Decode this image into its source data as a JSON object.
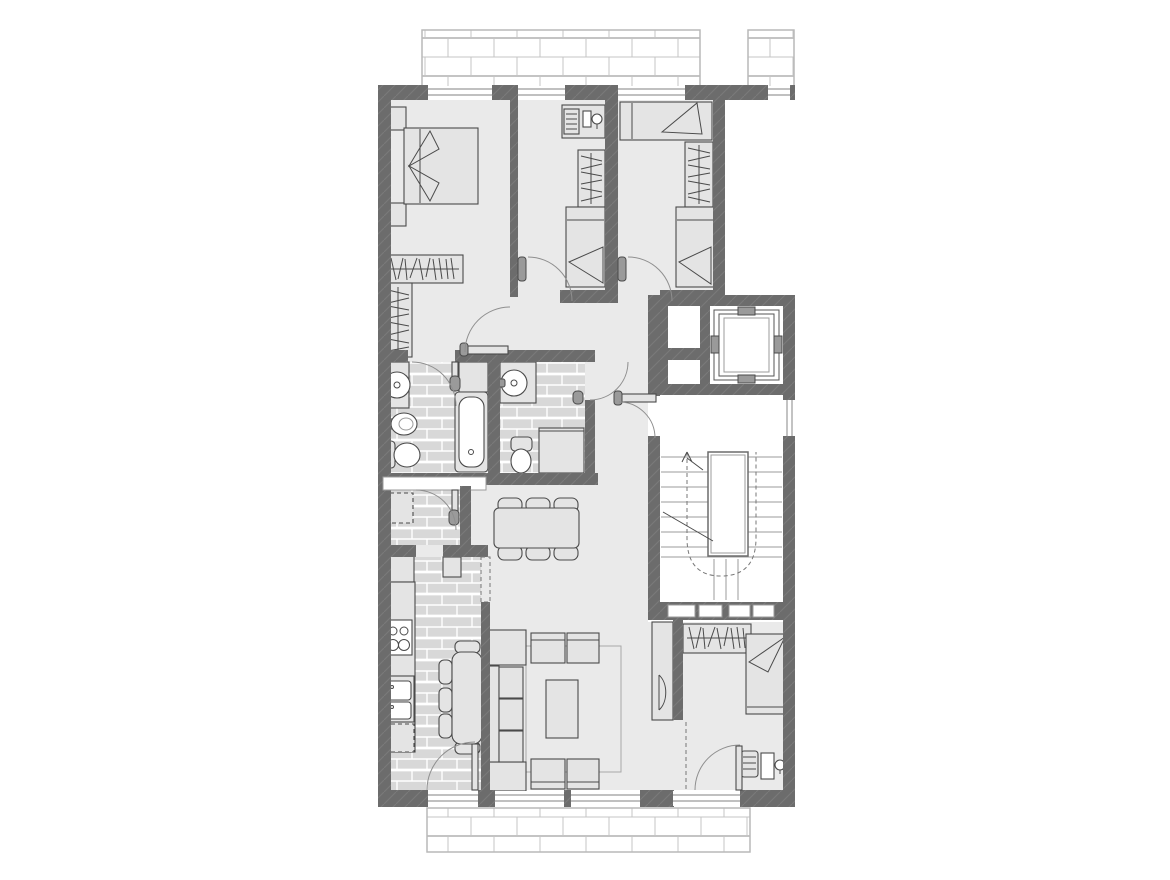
{
  "document": {
    "kind": "apartment-floor-plan"
  },
  "colors": {
    "background": "#ffffff",
    "wall": "#6c6c6c",
    "wall_hatch": "#7a7a7a",
    "floor": "#eaeaea",
    "tile": "#d8d8d8",
    "tile_joint": "#ffffff",
    "balcony_brick_line": "#c4c4c4",
    "furniture": "#e4e4e4",
    "fixture_white": "#ffffff",
    "outline": "#4a4a4a",
    "frame": "#9b9b9b",
    "arc": "#8f8f8f",
    "dashed": "#777777",
    "handle": "#9a9a9a"
  },
  "plan": {
    "rooms": [
      {
        "id": "bedroom-1"
      },
      {
        "id": "bedroom-2"
      },
      {
        "id": "bedroom-3"
      },
      {
        "id": "bedroom-4"
      },
      {
        "id": "bathroom-1"
      },
      {
        "id": "bathroom-2"
      },
      {
        "id": "hallway"
      },
      {
        "id": "vestibule"
      },
      {
        "id": "kitchen"
      },
      {
        "id": "living-dining-room"
      },
      {
        "id": "stair-landing"
      },
      {
        "id": "stairwell"
      },
      {
        "id": "elevator-shaft"
      },
      {
        "id": "service-duct"
      },
      {
        "id": "balcony-north"
      },
      {
        "id": "balcony-north-east"
      },
      {
        "id": "balcony-south"
      }
    ],
    "furniture": [
      "double-bed",
      "nightstand",
      "wardrobe",
      "single-bed",
      "desk",
      "desk-chair",
      "washbasin",
      "bidet",
      "toilet",
      "bathtub",
      "shower",
      "fridge",
      "tall-cabinet",
      "stove",
      "kitchen-sink",
      "dishwasher",
      "breakfast-table",
      "dining-table",
      "chair",
      "sofa",
      "side-table",
      "armchair",
      "coffee-table",
      "rug",
      "tv-cabinet",
      "stairs",
      "elevator-car"
    ]
  }
}
